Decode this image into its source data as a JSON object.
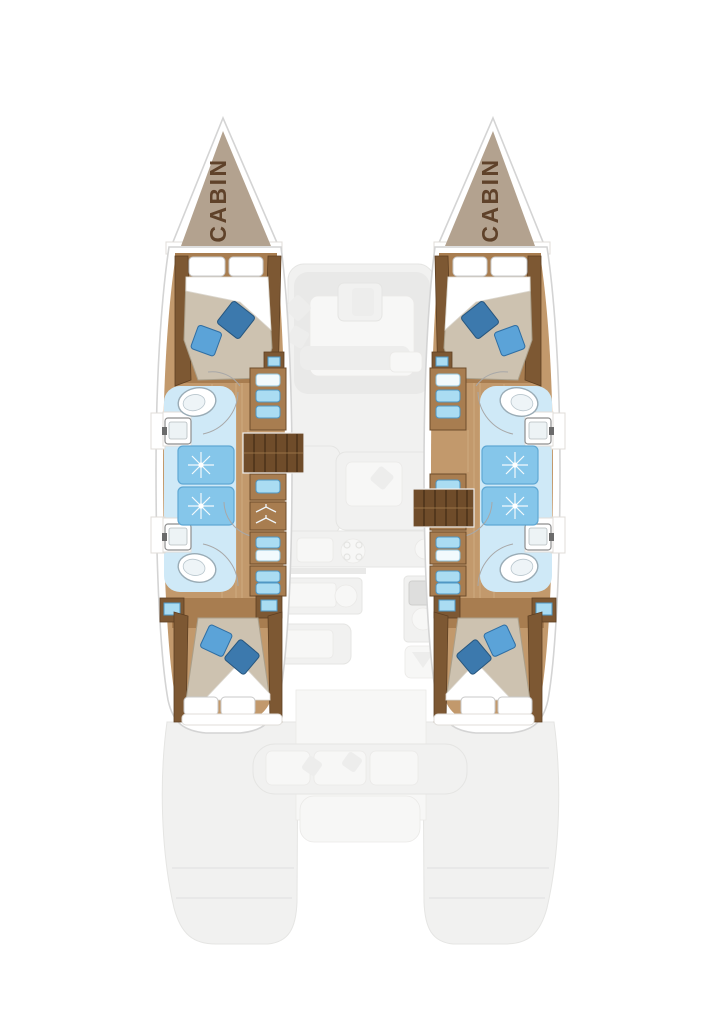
{
  "floorplan": {
    "hulls": {
      "port": {
        "bow_label": "CABIN"
      },
      "starboard": {
        "bow_label": "CABIN"
      }
    },
    "icons": {
      "toilet-icon": "white oval bowl",
      "sink-icon": "square basin with faucet",
      "shower-icon": "blue tray with spray starburst",
      "companionway-stairs": "dark wood treads",
      "hanger-icon": "clothes hanger outline",
      "towel-icon": "folded towel rectangle",
      "bed-pillow": "rotated square cushion"
    },
    "colors": {
      "bow-triangle": "#b3a28f",
      "label-text": "#5f422a",
      "hull-stroke": "#d4d4d4",
      "wood-floor": "#c2996c",
      "wood-mid": "#a87d50",
      "wood-dark": "#7d5833",
      "stair-wood": "#6f4c2a",
      "bed-cover": "#cdc2b0",
      "pillow-blue": "#5ba3d8",
      "pillow-blue-dark": "#3c79ad",
      "bath-floor": "#cfe9f7",
      "shower-blue": "#85c6ea",
      "towel-blue": "#aadcf2",
      "ghost-grey": "#f1f1f0"
    }
  }
}
